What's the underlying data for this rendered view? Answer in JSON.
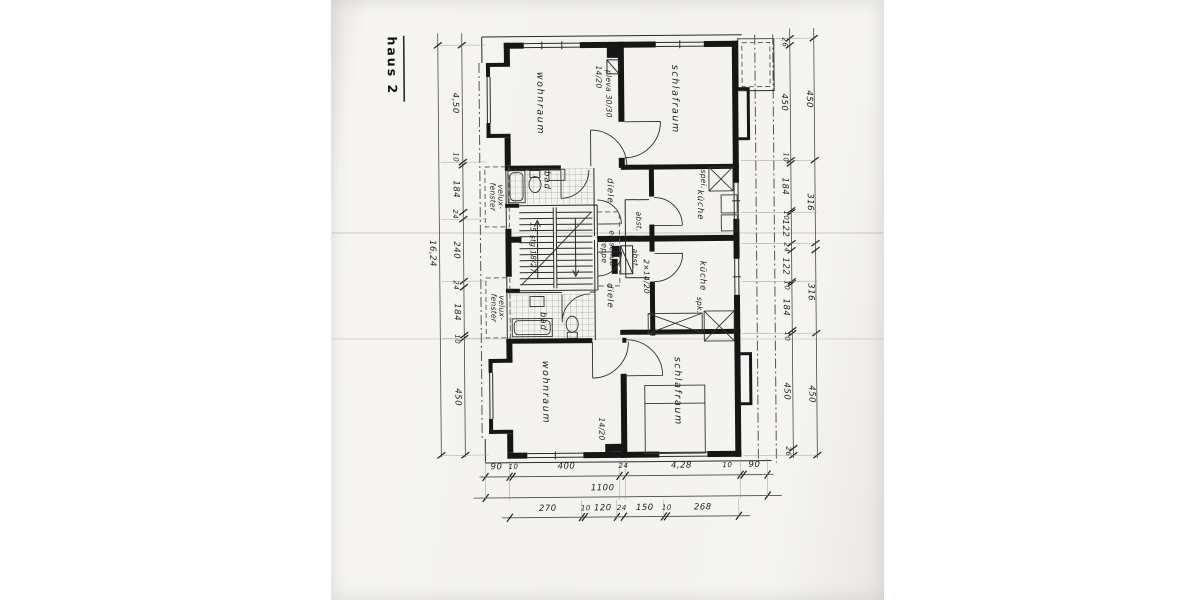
{
  "title": "haus 2",
  "colors": {
    "paper": "#f3f2ee",
    "ink": "#1e1e1e",
    "wall": "#161616"
  },
  "labels": {
    "haus": "haus 2",
    "wohnraum_top": "wohnraum",
    "schlafraum_top": "schlafraum",
    "kueche_top": "küche",
    "diele_top": "diele",
    "bad_top": "bad",
    "abst_top": "abst.",
    "spei": "spei.",
    "chimney_top_a": "14/20",
    "chimney_top_b": "pleva 30/30",
    "einschub": "einschub- treppe",
    "stairs": "15 stg 18/27",
    "abst_bottom": "abst.",
    "chimney_mid": "2×14/20",
    "diele_bottom": "diele",
    "bad_bottom": "bad",
    "kueche_bottom": "küche",
    "spk": "spk.",
    "wohnraum_bottom": "wohnraum",
    "schlafraum_bottom": "schlafraum",
    "chimney_bottom": "14/20",
    "velux_1": "velux- fenster",
    "velux_2": "velux- fenster"
  },
  "dims": {
    "left_inner": [
      "4,50",
      "10",
      "184",
      "24",
      "240",
      "24",
      "184",
      "10",
      "450"
    ],
    "left_outer": [
      "16,24"
    ],
    "right_inner": [
      "26",
      "450",
      "10",
      "184",
      "10",
      "122",
      "24",
      "122",
      "10",
      "184",
      "10",
      "450",
      "26"
    ],
    "right_outer": [
      "450",
      "316",
      "316",
      "450"
    ],
    "bottom_upper": [
      "90",
      "10",
      "400",
      "24",
      "4,28",
      "10",
      "90"
    ],
    "bottom_total": [
      "1100"
    ],
    "bottom_lower": [
      "270",
      "10",
      "120",
      "24",
      "150",
      "10",
      "268"
    ]
  }
}
